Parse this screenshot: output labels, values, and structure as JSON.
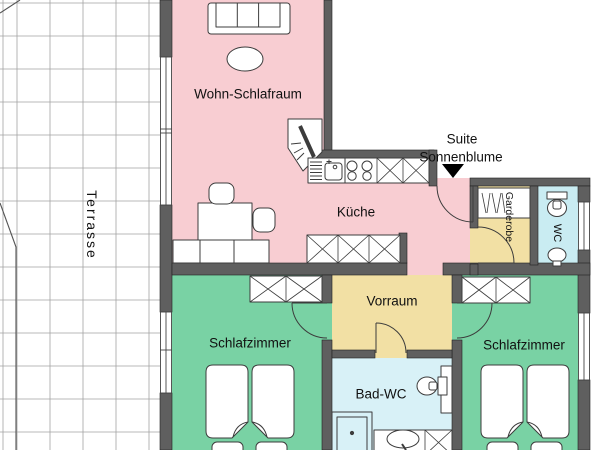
{
  "plan": {
    "suite_label_line1": "Suite",
    "suite_label_line2": "Sonnenblume",
    "rooms": {
      "terrasse": {
        "label": "Terrasse",
        "color": "#ffffff"
      },
      "wohn_schlafraum": {
        "label": "Wohn-Schlafraum",
        "color": "#f8cdd2"
      },
      "kueche": {
        "label": "Küche",
        "color": "#f8cdd2"
      },
      "vorraum": {
        "label": "Vorraum",
        "color": "#f2e0a4"
      },
      "garderobe": {
        "label": "Garderobe",
        "color": "#f2e0a4"
      },
      "wc": {
        "label": "WC",
        "color": "#c9ecf2"
      },
      "bad_wc": {
        "label": "Bad-WC",
        "color": "#d8f1f7"
      },
      "schlafzimmer_links": {
        "label": "Schlafzimmer",
        "color": "#79d2a4"
      },
      "schlafzimmer_rechts": {
        "label": "Schlafzimmer",
        "color": "#79d2a4"
      }
    },
    "colors": {
      "wall": "#5f5f5f",
      "grid": "#a3a3a3",
      "boundary": "#555555",
      "outline": "#3c3c3c",
      "entrance_arrow": "#000000"
    }
  }
}
